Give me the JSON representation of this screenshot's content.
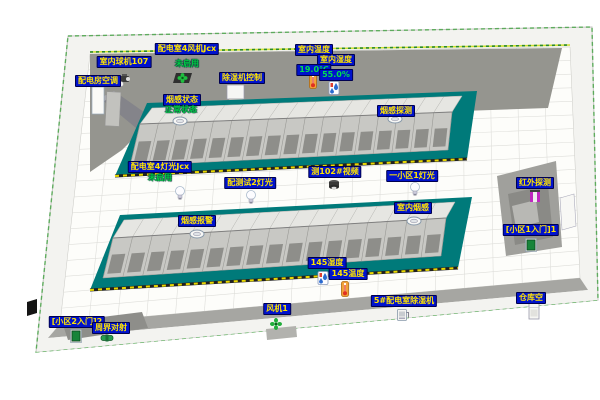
{
  "colors": {
    "label_bg": "#0012cc",
    "label_text": "#ffe400",
    "status_text": "#00cc44",
    "value_text": "#00e050",
    "platform": "#007a7a",
    "back_wall": "#95958f",
    "rack_top": "#e6e6e2",
    "rack_front": "#c8c8c4",
    "floor": "#fdfdfa",
    "wall_band": "#f3f3f0",
    "border_green": "#3aa03a",
    "hazard_yellow": "#e8d800"
  },
  "labels": [
    {
      "id": "indoor-dome-camera-107",
      "text": "室内球机107",
      "x": 124,
      "y": 56,
      "type": "tag"
    },
    {
      "id": "power-room-ac",
      "text": "配电房空调",
      "x": 98,
      "y": 75,
      "type": "tag"
    },
    {
      "id": "power-room-4-fan",
      "text": "配电室4风机Jcx",
      "x": 187,
      "y": 43,
      "type": "tag"
    },
    {
      "id": "fan-status",
      "text": "未启用",
      "x": 187,
      "y": 59,
      "type": "status"
    },
    {
      "id": "dehumidifier-control",
      "text": "除湿机控制",
      "x": 242,
      "y": 72,
      "type": "tag"
    },
    {
      "id": "indoor-temp",
      "text": "室内温度",
      "x": 314,
      "y": 44,
      "type": "tag"
    },
    {
      "id": "indoor-humidity",
      "text": "室内湿度",
      "x": 336,
      "y": 54,
      "type": "tag"
    },
    {
      "id": "indoor-temp-value",
      "text": "19.0℃",
      "x": 314,
      "y": 64,
      "type": "value"
    },
    {
      "id": "indoor-humidity-value",
      "text": "55.0%",
      "x": 336,
      "y": 69,
      "type": "value"
    },
    {
      "id": "smoke-status",
      "text": "烟感状态",
      "x": 182,
      "y": 94,
      "type": "tag"
    },
    {
      "id": "smoke-status-value",
      "text": "正常状态",
      "x": 181,
      "y": 105,
      "type": "status"
    },
    {
      "id": "smoke-detect",
      "text": "烟感探测",
      "x": 396,
      "y": 105,
      "type": "tag"
    },
    {
      "id": "power-room-4-light",
      "text": "配电室4灯光Jcx",
      "x": 160,
      "y": 161,
      "type": "tag"
    },
    {
      "id": "light-status",
      "text": "未启用",
      "x": 160,
      "y": 173,
      "type": "status"
    },
    {
      "id": "test-2-light",
      "text": "配测试2灯光",
      "x": 250,
      "y": 177,
      "type": "tag"
    },
    {
      "id": "video-102",
      "text": "测102#视频",
      "x": 335,
      "y": 166,
      "type": "tag"
    },
    {
      "id": "area1-light",
      "text": "一小区1灯光",
      "x": 412,
      "y": 170,
      "type": "tag"
    },
    {
      "id": "indoor-smoke",
      "text": "室内烟感",
      "x": 413,
      "y": 202,
      "type": "tag"
    },
    {
      "id": "smoke-alarm",
      "text": "烟感报警",
      "x": 197,
      "y": 215,
      "type": "tag"
    },
    {
      "id": "infrared-detect",
      "text": "红外探测",
      "x": 535,
      "y": 177,
      "type": "tag"
    },
    {
      "id": "area1-entrance",
      "text": "[小区1入门]1",
      "x": 531,
      "y": 224,
      "type": "tag"
    },
    {
      "id": "humidity-145",
      "text": "145湿度",
      "x": 327,
      "y": 257,
      "type": "tag"
    },
    {
      "id": "temp-145",
      "text": "145温度",
      "x": 348,
      "y": 268,
      "type": "tag"
    },
    {
      "id": "fan-1",
      "text": "风机1",
      "x": 277,
      "y": 303,
      "type": "tag"
    },
    {
      "id": "dehumidifier-5",
      "text": "5#配电室除湿机",
      "x": 404,
      "y": 295,
      "type": "tag"
    },
    {
      "id": "warehouse-ac",
      "text": "仓库空",
      "x": 531,
      "y": 292,
      "type": "tag"
    },
    {
      "id": "area2-entrance",
      "text": "[小区2入门]2",
      "x": 77,
      "y": 316,
      "type": "tag"
    },
    {
      "id": "perimeter-beam",
      "text": "周界对射",
      "x": 111,
      "y": 322,
      "type": "tag"
    }
  ],
  "devices": [
    {
      "id": "dome-camera-107-device",
      "icon": "ptz-camera-icon",
      "x": 125,
      "y": 80
    },
    {
      "id": "fan-top-device",
      "icon": "fan-dark-icon",
      "x": 183,
      "y": 78
    },
    {
      "id": "indoor-thermometer",
      "icon": "thermometer-icon",
      "x": 313,
      "y": 81
    },
    {
      "id": "indoor-humidity-device",
      "icon": "humidity-icon",
      "x": 334,
      "y": 88
    },
    {
      "id": "smoke-detector-wall",
      "icon": "smoke-detector-icon",
      "x": 180,
      "y": 121
    },
    {
      "id": "smoke-detector-row1",
      "icon": "smoke-detector-icon",
      "x": 395,
      "y": 119
    },
    {
      "id": "bulb-room4",
      "icon": "bulb-icon",
      "x": 180,
      "y": 194
    },
    {
      "id": "bulb-test2",
      "icon": "bulb-icon",
      "x": 251,
      "y": 198
    },
    {
      "id": "camera-102-device",
      "icon": "dome-camera-icon",
      "x": 334,
      "y": 185
    },
    {
      "id": "bulb-area1",
      "icon": "bulb-icon",
      "x": 415,
      "y": 190
    },
    {
      "id": "smoke-detector-indoor",
      "icon": "smoke-detector-icon",
      "x": 414,
      "y": 221
    },
    {
      "id": "smoke-detector-alarm",
      "icon": "smoke-detector-icon",
      "x": 197,
      "y": 234
    },
    {
      "id": "infrared-sensor-device",
      "icon": "infrared-icon",
      "x": 535,
      "y": 196
    },
    {
      "id": "door-area1-device",
      "icon": "door-icon",
      "x": 531,
      "y": 245
    },
    {
      "id": "humidity-145-device",
      "icon": "humidity-icon",
      "x": 323,
      "y": 278
    },
    {
      "id": "thermometer-145-device",
      "icon": "thermometer-icon",
      "x": 345,
      "y": 289
    },
    {
      "id": "fan-1-device",
      "icon": "fan-green-icon",
      "x": 276,
      "y": 324
    },
    {
      "id": "dehumidifier-5-device",
      "icon": "dehumidifier-icon",
      "x": 403,
      "y": 315
    },
    {
      "id": "warehouse-ac-unit",
      "icon": "cabinet-icon",
      "x": 534,
      "y": 311
    },
    {
      "id": "door-area2-device",
      "icon": "door-icon",
      "x": 76,
      "y": 336
    },
    {
      "id": "perimeter-beam-device",
      "icon": "beam-device-icon",
      "x": 107,
      "y": 338
    }
  ]
}
